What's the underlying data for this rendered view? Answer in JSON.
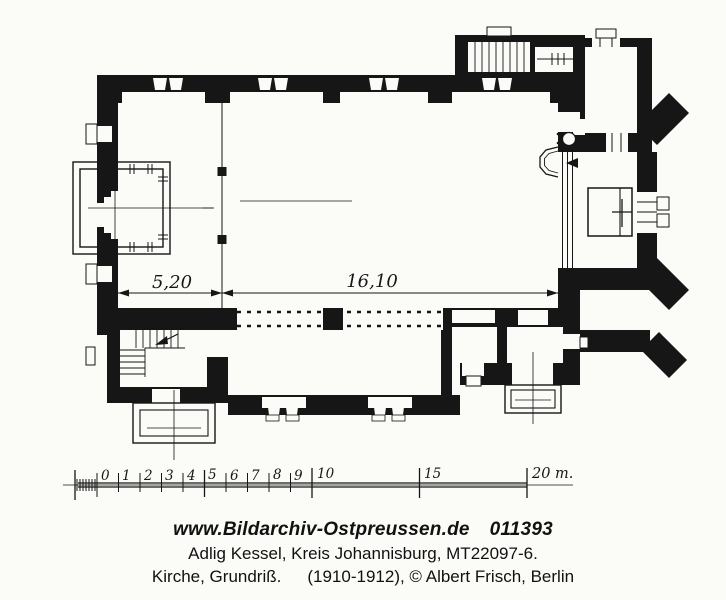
{
  "plan": {
    "title_meaning": "church ground plan drawing",
    "dimensions": {
      "west_bay": "5,20",
      "nave_length": "16,10"
    }
  },
  "scale_bar": {
    "ticks": [
      "0",
      "1",
      "2",
      "3",
      "4",
      "5",
      "6",
      "7",
      "8",
      "9",
      "10",
      "15"
    ],
    "end_label": "20 m."
  },
  "caption": {
    "website": "www.Bildarchiv-Ostpreussen.de",
    "archive_number": "011393",
    "location_line": "Adlig Kessel, Kreis Johannisburg, MT22097-6.",
    "subject": "Kirche, Grundriß.",
    "credit": "(1910-1912), © Albert Frisch, Berlin"
  },
  "colors": {
    "ink": "#161616",
    "paper": "#fbfbf8"
  }
}
